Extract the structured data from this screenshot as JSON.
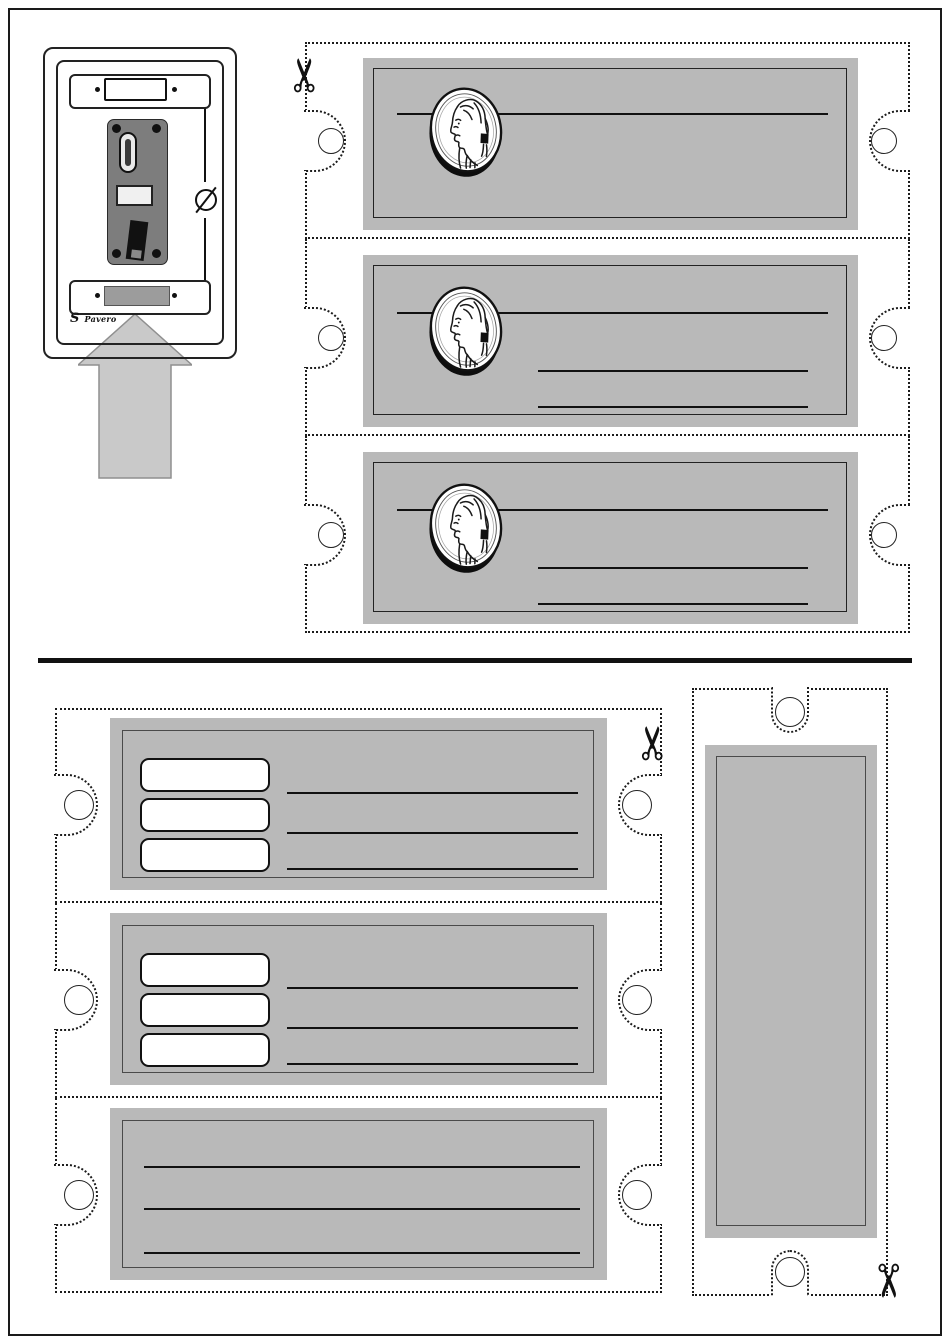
{
  "page": {
    "type": "printable-label-template",
    "background": "#ffffff",
    "frame_color": "#1a1a1a"
  },
  "branding": {
    "logo_mark": "S",
    "logo_text": "Pavero"
  },
  "icons": {
    "scissors": "✂",
    "coin": "jefferson-nickel-profile",
    "screw": "slotted-screw-head",
    "arrow": "insert-label-up-arrow"
  },
  "colors": {
    "panel_gray": "#b9b9b9",
    "plate_gray": "#7d7d7d",
    "arrow_gray": "#c9c9c9",
    "label_box_gray": "#9c9c9c",
    "line_black": "#111111"
  },
  "coin_label_section": {
    "count": 3,
    "cards": [
      {
        "name": "coin-label-1",
        "coin_image": "jefferson-nickel",
        "header_lines": 1,
        "value_lines": 0,
        "punch_holes": 2
      },
      {
        "name": "coin-label-2",
        "coin_image": "jefferson-nickel",
        "header_lines": 1,
        "value_lines": 2,
        "punch_holes": 2
      },
      {
        "name": "coin-label-3",
        "coin_image": "jefferson-nickel",
        "header_lines": 1,
        "value_lines": 2,
        "punch_holes": 2
      }
    ]
  },
  "price_label_section": {
    "left_cards": [
      {
        "name": "price-label-1",
        "price_boxes": 3,
        "write_lines": 3,
        "punch_holes": 2
      },
      {
        "name": "price-label-2",
        "price_boxes": 3,
        "write_lines": 3,
        "punch_holes": 2
      },
      {
        "name": "price-label-3",
        "price_boxes": 0,
        "write_lines": 3,
        "punch_holes": 2
      }
    ],
    "right_card": {
      "name": "vertical-blank-label",
      "price_boxes": 0,
      "write_lines": 0,
      "punch_holes": 2
    }
  }
}
